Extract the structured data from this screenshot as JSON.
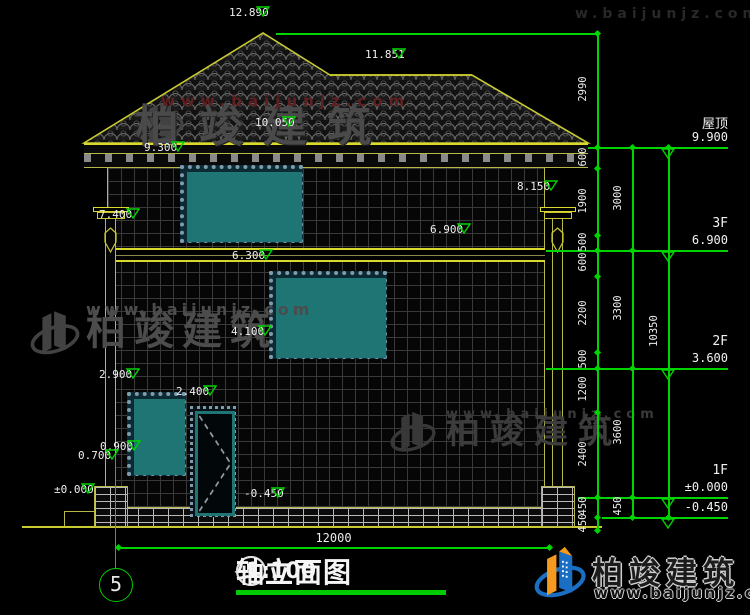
{
  "drawing": {
    "title_block": {
      "axis_start": "5",
      "axis_end": "1",
      "separator": "—",
      "title": "轴立面图",
      "scale": "1:100"
    },
    "axis_bubble": {
      "label": "5"
    },
    "bottom_dim": {
      "label": "12000",
      "x1": 118,
      "x2": 549,
      "y": 547
    },
    "feature_markers": [
      {
        "label": "12.890",
        "x": 263,
        "y": 33
      },
      {
        "label": "11.851",
        "x": 399,
        "y": 75
      },
      {
        "label": "10.050",
        "x": 289,
        "y": 143
      },
      {
        "label": "9.300",
        "x": 178,
        "y": 168
      },
      {
        "label": "8.150",
        "x": 551,
        "y": 207
      },
      {
        "label": "7.400",
        "x": 133,
        "y": 235
      },
      {
        "label": "6.900",
        "x": 464,
        "y": 250
      },
      {
        "label": "6.300",
        "x": 266,
        "y": 276
      },
      {
        "label": "4.100",
        "x": 265,
        "y": 352
      },
      {
        "label": "2.900",
        "x": 133,
        "y": 395
      },
      {
        "label": "2.400",
        "x": 210,
        "y": 412
      },
      {
        "label": "0.900",
        "x": 134,
        "y": 467
      },
      {
        "label": "0.700",
        "x": 112,
        "y": 476
      },
      {
        "label": "±0.000",
        "x": 88,
        "y": 510
      },
      {
        "label": "-0.450",
        "x": 278,
        "y": 514
      }
    ],
    "right_markers": [
      {
        "floor": "屋顶",
        "value": "9.900",
        "y": 147
      },
      {
        "floor": "3F",
        "value": "6.900",
        "y": 250
      },
      {
        "floor": "2F",
        "value": "3.600",
        "y": 368
      },
      {
        "floor": "1F",
        "value": "±0.000",
        "y": 497
      },
      {
        "floor": "",
        "value": "-0.450",
        "y": 517
      }
    ],
    "chains": {
      "inner": {
        "x": 597,
        "segments": [
          [
            "2990",
            33,
            147
          ],
          [
            "600",
            147,
            168
          ],
          [
            "1900",
            168,
            235
          ],
          [
            "500",
            235,
            250
          ],
          [
            "600",
            250,
            276
          ],
          [
            "2200",
            276,
            352
          ],
          [
            "500",
            352,
            368
          ],
          [
            "1200",
            368,
            412
          ],
          [
            "2400",
            412,
            497
          ],
          [
            "450",
            497,
            517
          ],
          [
            "450",
            517,
            530
          ]
        ]
      },
      "middle": {
        "x": 632,
        "segments": [
          [
            "3000",
            147,
            250
          ],
          [
            "3300",
            250,
            368
          ],
          [
            "3600",
            368,
            497
          ],
          [
            "450",
            497,
            517
          ]
        ]
      },
      "outer": {
        "x": 668,
        "segments": [
          [
            "10350",
            147,
            517
          ]
        ]
      }
    },
    "connectors": [
      {
        "x1": 276,
        "x2": 600,
        "y": 33
      },
      {
        "x1": 588,
        "x2": 655,
        "y": 147
      },
      {
        "x1": 546,
        "x2": 655,
        "y": 250
      },
      {
        "x1": 546,
        "x2": 655,
        "y": 368
      },
      {
        "x1": 578,
        "x2": 655,
        "y": 497
      },
      {
        "x1": 602,
        "x2": 655,
        "y": 517
      }
    ]
  },
  "watermark": {
    "brand": "柏竣建筑",
    "url": "www.baijunjz.com",
    "partial": "w.baijunjz.com"
  },
  "colors": {
    "dimension_green": "#00d400",
    "structure_yellow": "#b8b84a",
    "highlight_yellow": "#d9d92e",
    "window_teal": "#1f7474",
    "logo_blue": "#1a6fc4",
    "logo_orange": "#f59a1e"
  }
}
